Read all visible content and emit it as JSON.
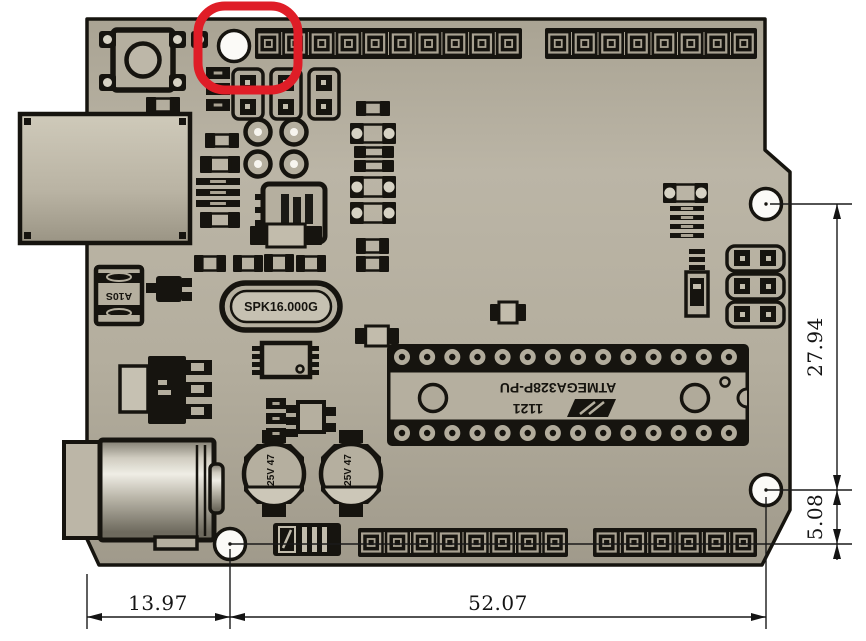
{
  "dimensions": {
    "bottom_left_mm": "13.97",
    "bottom_right_mm": "52.07",
    "right_upper_mm": "27.94",
    "right_lower_mm": "5.08"
  },
  "silkscreen": {
    "crystal": "SPK16.000G",
    "mcu_line1": "ATMEGA328P-PU",
    "mcu_line2": "1121",
    "diode": "A10S",
    "capacitor": "25V 47"
  },
  "colors": {
    "board": "#b5af9f",
    "silk_black": "#16140f",
    "highlight_red": "#df1d27",
    "hole_white": "#fbfaf7"
  }
}
